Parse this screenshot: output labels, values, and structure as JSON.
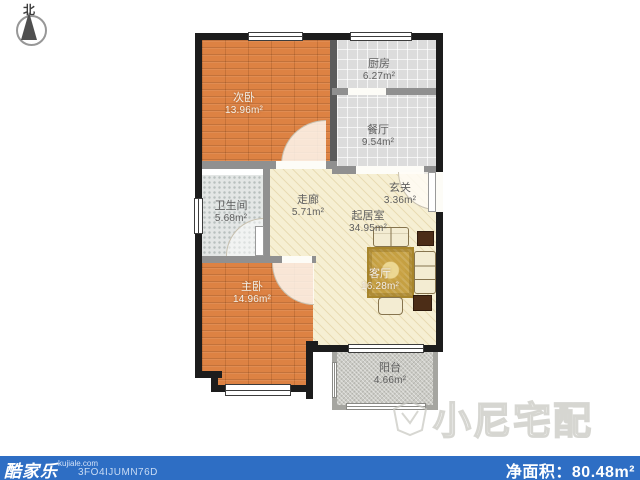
{
  "compass": {
    "north_label": "北"
  },
  "watermark": {
    "text": "小尼宅配"
  },
  "rooms": [
    {
      "name": "次卧",
      "area": "13.96m²"
    },
    {
      "name": "厨房",
      "area": "6.27m²"
    },
    {
      "name": "餐厅",
      "area": "9.54m²"
    },
    {
      "name": "卫生间",
      "area": "5.68m²"
    },
    {
      "name": "走廊",
      "area": "5.71m²"
    },
    {
      "name": "玄关",
      "area": "3.36m²"
    },
    {
      "name": "起居室",
      "area": "34.95m²"
    },
    {
      "name": "客厅",
      "area": "16.28m²"
    },
    {
      "name": "主卧",
      "area": "14.96m²"
    },
    {
      "name": "阳台",
      "area": "4.66m²"
    }
  ],
  "footer": {
    "brand": "酷家乐",
    "brand_site": "kujiale.com",
    "plan_code": "3FO4IJUMN76D",
    "net_area_label": "净面积：",
    "net_area_value": "80.48m²"
  },
  "colors": {
    "bar": "#2e6ec4",
    "wall": "#1c1c1c",
    "iwall": "#909090",
    "iwall-dark": "#5c5c5c",
    "wood": "#dd8243",
    "tile": "#dcdcdc",
    "bath": "#e3e6e5",
    "cream": "#f6efd3",
    "balcony": "#cbcbc5",
    "rug": "#c5a042",
    "sofa": "#f3ecd2",
    "table": "#4c2d17",
    "label": "#5f5f5f",
    "label-light": "#f2f0ea"
  }
}
